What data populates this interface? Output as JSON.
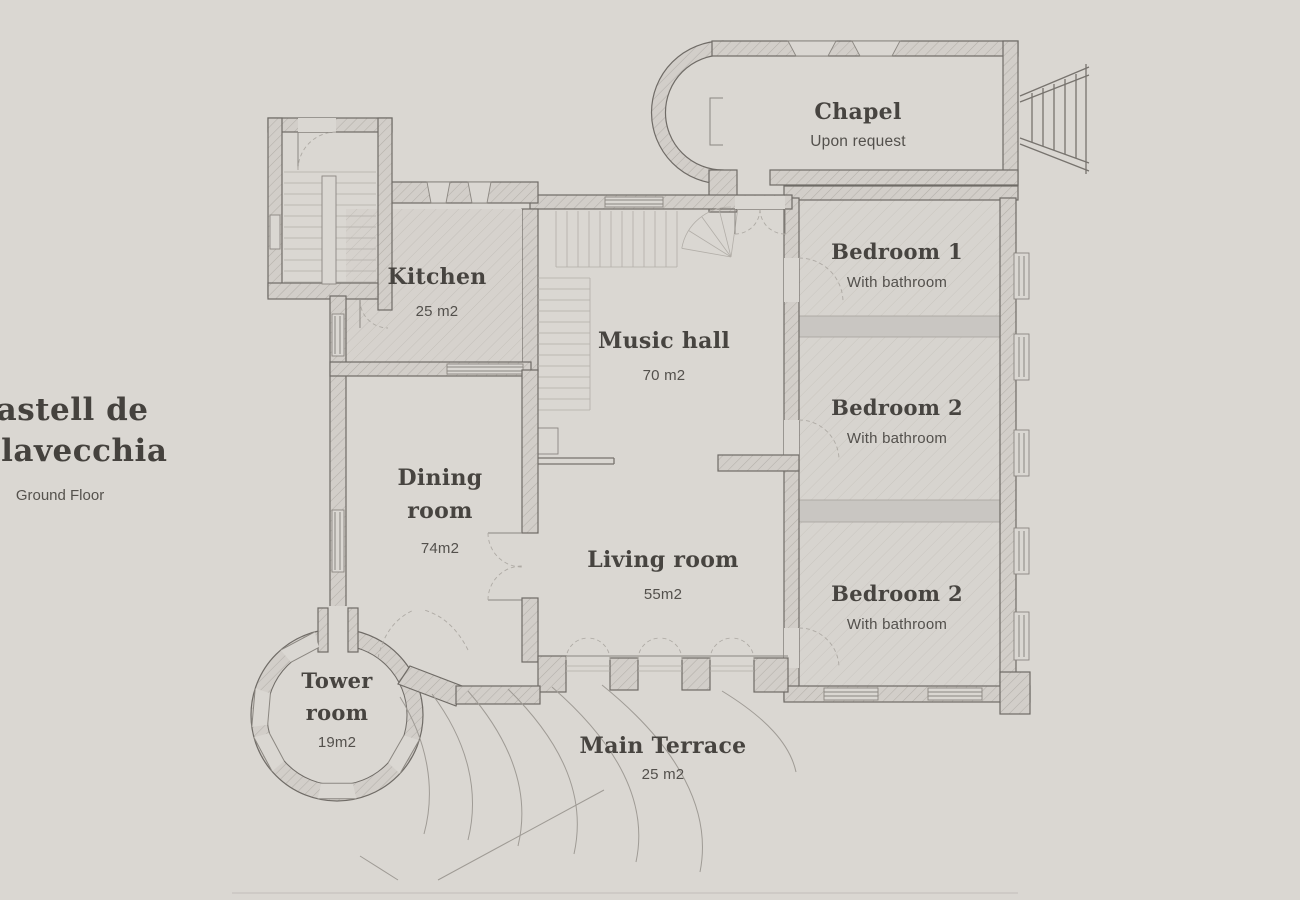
{
  "title": {
    "line1": "Castell de",
    "line2": "Villavecchia",
    "subtitle": "Ground Floor"
  },
  "rooms": {
    "chapel": {
      "name": "Chapel",
      "detail": "Upon request"
    },
    "kitchen": {
      "name": "Kitchen",
      "detail": "25 m2"
    },
    "music_hall": {
      "name": "Music hall",
      "detail": "70 m2"
    },
    "bedroom_1": {
      "name": "Bedroom 1",
      "detail": "With bathroom"
    },
    "bedroom_2": {
      "name": "Bedroom 2",
      "detail": "With bathroom"
    },
    "bedroom_3": {
      "name": "Bedroom 2",
      "detail": "With bathroom"
    },
    "dining_room": {
      "name": "Dining room",
      "detail": "74m2"
    },
    "living_room": {
      "name": "Living room",
      "detail": "55m2"
    },
    "tower_room": {
      "name": "Tower room",
      "detail": "19m2"
    },
    "main_terrace": {
      "name": "Main Terrace",
      "detail": "25 m2"
    }
  },
  "colors": {
    "background": "#dad7d2",
    "wall_outline": "#6f6b66",
    "wall_hatch": "#b3afa9",
    "corridor_band": "#c9c6c2",
    "text_primary": "#474440",
    "text_secondary": "#53504c"
  }
}
